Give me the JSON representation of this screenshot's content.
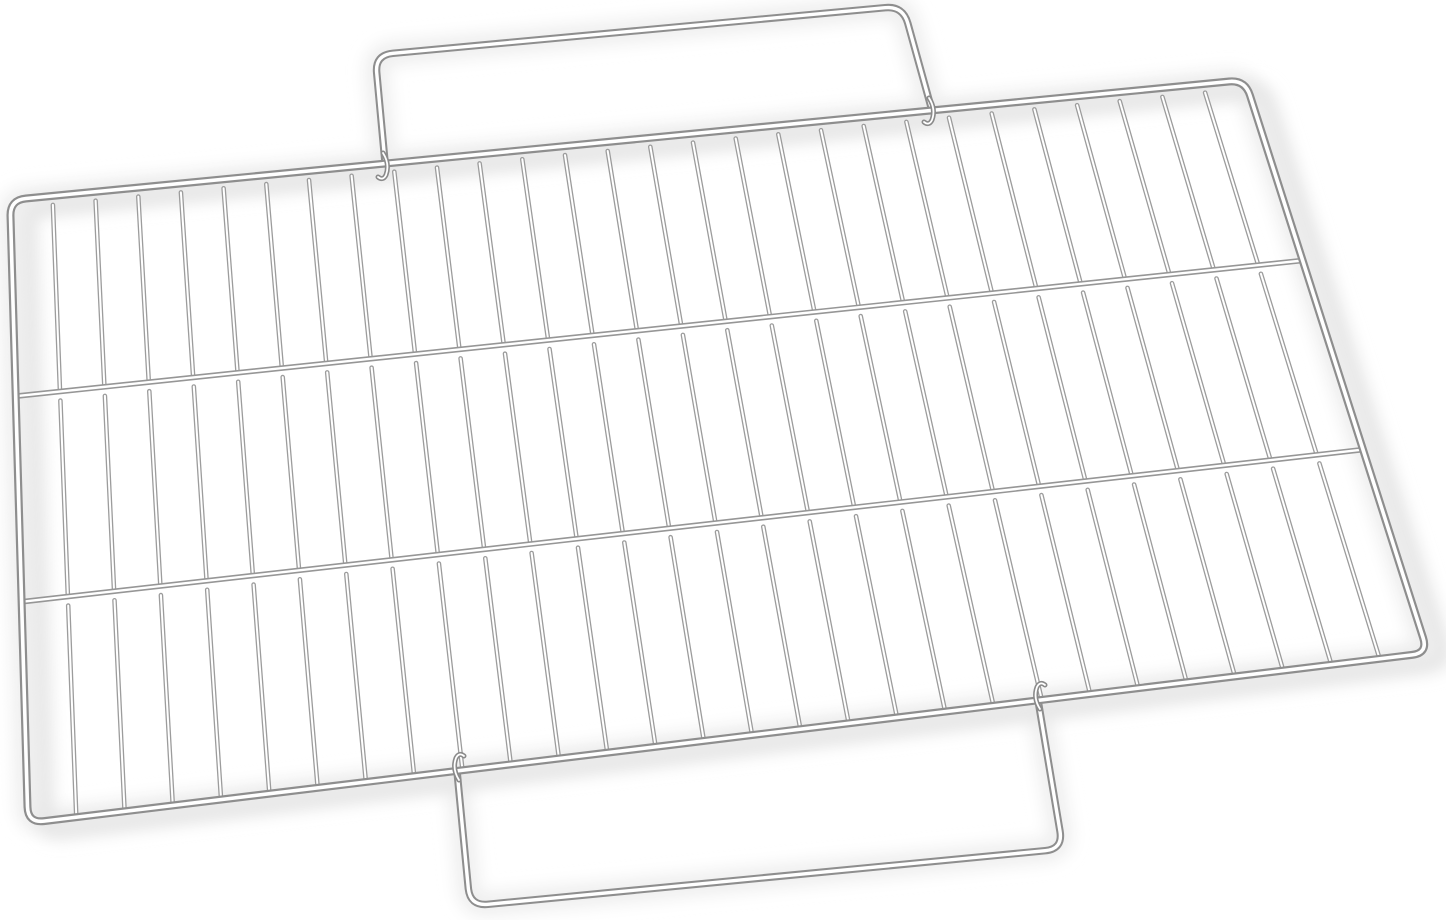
{
  "scene": {
    "description": "Chrome-plated steel wire grill grate with top and bottom carry handles, photographed at a slight angle on a plain white background",
    "background_color": "#ffffff"
  },
  "grate": {
    "frame_quad": {
      "tl": [
        10,
        200
      ],
      "tr": [
        1245,
        80
      ],
      "br": [
        1428,
        653
      ],
      "bl": [
        28,
        823
      ]
    },
    "frame_corner_radius": 16,
    "crossbar_fractions": [
      0.315,
      0.645
    ],
    "rod_count": 28,
    "rod_tip_gap_px": 9,
    "handles": {
      "top": {
        "points": [
          [
            385,
            162
          ],
          [
            375,
            55
          ],
          [
            903,
            6
          ],
          [
            931,
            107
          ]
        ],
        "corner_radius": 18,
        "hook_direction": "down"
      },
      "bottom": {
        "points": [
          [
            457,
            771
          ],
          [
            470,
            906
          ],
          [
            1063,
            849
          ],
          [
            1038,
            700
          ]
        ],
        "corner_radius": 18,
        "hook_direction": "up"
      }
    },
    "wire_style": {
      "highlight_color": "#ffffff",
      "frame": {
        "width": 8,
        "edge": "#8e8e8e",
        "highlight_width": 3.6
      },
      "crossbar": {
        "width": 5.6,
        "edge": "#969696",
        "highlight_width": 2.4
      },
      "rod": {
        "width": 4.6,
        "edge": "#9c9c9c",
        "highlight_width": 2.0
      },
      "handle": {
        "width": 7.5,
        "edge": "#8e8e8e",
        "highlight_width": 3.4
      },
      "hook": {
        "width": 5,
        "edge": "#8a8a8a",
        "highlight_width": 1.8
      }
    },
    "shadow": {
      "halo_color": "#efefef",
      "halo_width": 24,
      "accent_color": "#e6e6e6",
      "accent_width": 18,
      "accent_offset": [
        18,
        9
      ],
      "blur": 8
    }
  }
}
